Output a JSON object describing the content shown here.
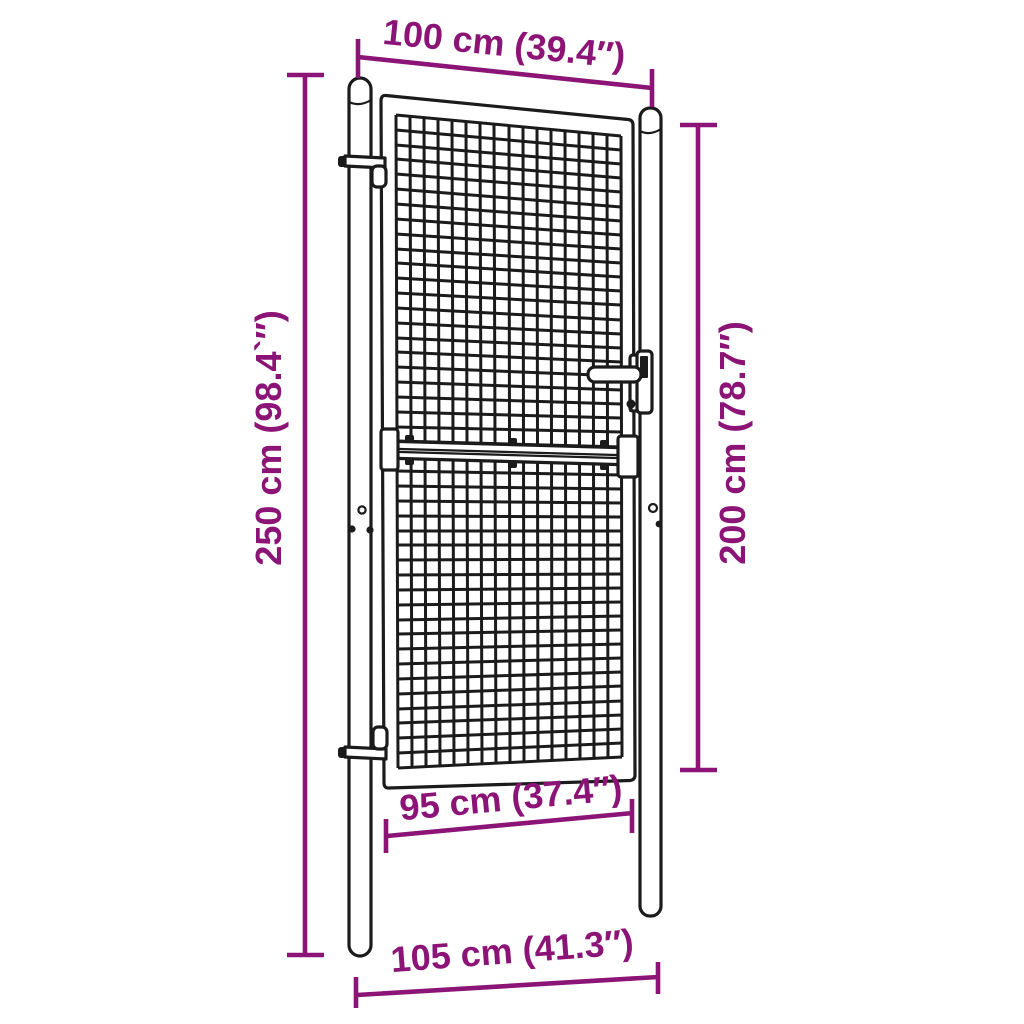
{
  "colors": {
    "accent": "#8B1476",
    "ink": "#1B1B1B",
    "bg": "#FFFFFF"
  },
  "labels": {
    "top_width": "100 cm (39.4″)",
    "left_height": "250 cm (98.4`″)",
    "right_height": "200 cm (78.7″)",
    "gate_width": "95 cm (37.4″)",
    "post_span": "105 cm (41.3″)"
  }
}
